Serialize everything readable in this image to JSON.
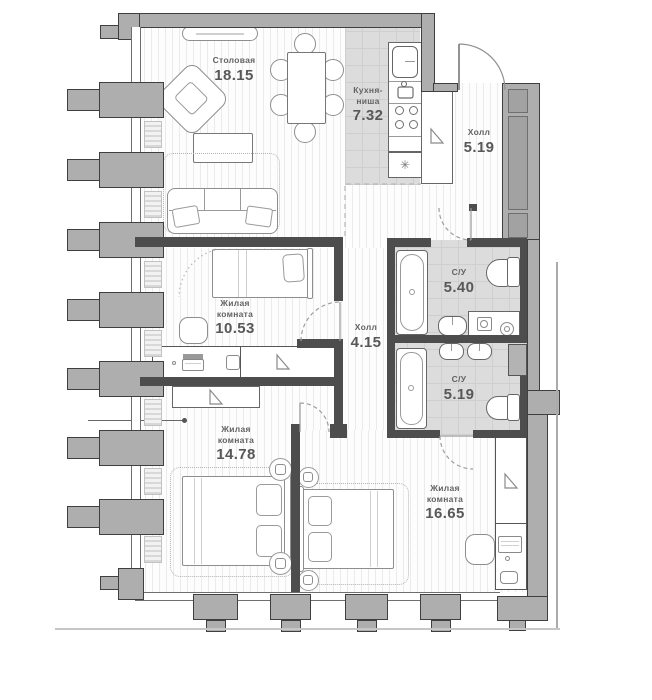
{
  "plan": {
    "rooms": [
      {
        "id": "dining",
        "name": "Столовая",
        "area": "18.15"
      },
      {
        "id": "kitchen-niche",
        "name": "Кухня-ниша",
        "area": "7.32"
      },
      {
        "id": "hall-entry",
        "name": "Холл",
        "area": "5.19"
      },
      {
        "id": "bathroom-1",
        "name": "С/У",
        "area": "5.40"
      },
      {
        "id": "bathroom-2",
        "name": "С/У",
        "area": "5.19"
      },
      {
        "id": "living-10",
        "name": "Жилая комната",
        "area": "10.53"
      },
      {
        "id": "hall-inner",
        "name": "Холл",
        "area": "4.15"
      },
      {
        "id": "living-14",
        "name": "Жилая комната",
        "area": "14.78"
      },
      {
        "id": "living-16",
        "name": "Жилая комната",
        "area": "16.65"
      }
    ],
    "icons": {
      "stove_burner": "✳"
    },
    "colors": {
      "wall_fill": "#aeaeae",
      "wall_outline": "#3f3f3f",
      "interior_wall": "#4d4d4d",
      "floor_stripe": "#ebebeb",
      "wet_floor": "#dcdcdc",
      "label_text": "#636363"
    }
  }
}
